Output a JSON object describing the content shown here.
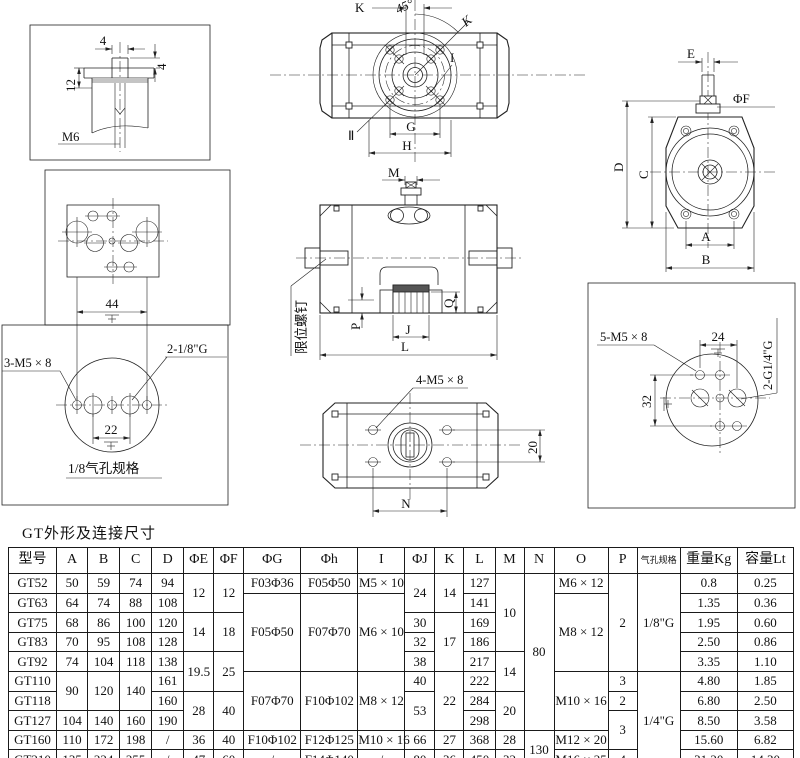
{
  "page_title": "GT外形及连接尺寸",
  "drawings": {
    "shaft_detail": {
      "dim_top": "4",
      "dim_right": "4",
      "dim_left": "12",
      "thread_label": "M6"
    },
    "top_view": {
      "dim_k": "K",
      "angle": "45°",
      "dim_k_diag": "K",
      "dim_i": "I",
      "dim_g": "G",
      "dim_h": "H",
      "mark": "Ⅱ"
    },
    "end_view": {
      "dim_e": "E",
      "dim_f": "ΦF",
      "dim_d": "D",
      "dim_c": "C",
      "dim_a": "A",
      "dim_b": "B"
    },
    "section_view": {
      "dim_m": "M",
      "dim_q": "Q",
      "dim_p": "P",
      "dim_j": "J",
      "dim_l": "L",
      "limit_screw_label": "限位螺钉"
    },
    "namur_plate": {
      "dim_width": "44"
    },
    "air_port_eighth": {
      "bolt_label": "3-M5 × 8",
      "port_label": "2-1/8\"G",
      "dim_width": "22",
      "caption": "1/8气孔规格"
    },
    "bottom_view": {
      "bolt_label": "4-M5 × 8",
      "dim_n": "N",
      "dim_height": "20"
    },
    "air_port_quarter": {
      "bolt_label": "5-M5 × 8",
      "dim_width": "24",
      "dim_height": "32",
      "port_label": "2-G1/4\"G"
    }
  },
  "table": {
    "headers": [
      "型号",
      "A",
      "B",
      "C",
      "D",
      "ΦE",
      "ΦF",
      "ΦG",
      "Φh",
      "I",
      "ΦJ",
      "K",
      "L",
      "M",
      "N",
      "O",
      "P",
      "气孔规格",
      "重量Kg",
      "容量Lt"
    ],
    "rows": [
      [
        {
          "t": "GT52"
        },
        {
          "t": "50"
        },
        {
          "t": "59"
        },
        {
          "t": "74"
        },
        {
          "t": "94"
        },
        {
          "t": "12",
          "rs": 2
        },
        {
          "t": "12",
          "rs": 2
        },
        {
          "t": "F03Φ36"
        },
        {
          "t": "F05Φ50"
        },
        {
          "t": "M5 × 10"
        },
        {
          "t": "24",
          "rs": 2
        },
        {
          "t": "14",
          "rs": 2
        },
        {
          "t": "127"
        },
        {
          "t": "10",
          "rs": 4
        },
        {
          "t": "80",
          "rs": 8
        },
        {
          "t": "M6 × 12"
        },
        {
          "t": "2",
          "rs": 5
        },
        {
          "t": "1/8\"G",
          "rs": 5
        },
        {
          "t": "0.8"
        },
        {
          "t": "0.25"
        }
      ],
      [
        {
          "t": "GT63"
        },
        {
          "t": "64"
        },
        {
          "t": "74"
        },
        {
          "t": "88"
        },
        {
          "t": "108"
        },
        {
          "t": "F05Φ50",
          "rs": 4
        },
        {
          "t": "F07Φ70",
          "rs": 4
        },
        {
          "t": "M6 × 10",
          "rs": 4
        },
        {
          "t": "141"
        },
        {
          "t": "M8 × 12",
          "rs": 4
        },
        {
          "t": "1.35"
        },
        {
          "t": "0.36"
        }
      ],
      [
        {
          "t": "GT75"
        },
        {
          "t": "68"
        },
        {
          "t": "86"
        },
        {
          "t": "100"
        },
        {
          "t": "120"
        },
        {
          "t": "14",
          "rs": 2
        },
        {
          "t": "18",
          "rs": 2
        },
        {
          "t": "30"
        },
        {
          "t": "17",
          "rs": 3
        },
        {
          "t": "169"
        },
        {
          "t": "1.95"
        },
        {
          "t": "0.60"
        }
      ],
      [
        {
          "t": "GT83"
        },
        {
          "t": "70"
        },
        {
          "t": "95"
        },
        {
          "t": "108"
        },
        {
          "t": "128"
        },
        {
          "t": "32"
        },
        {
          "t": "186"
        },
        {
          "t": "2.50"
        },
        {
          "t": "0.86"
        }
      ],
      [
        {
          "t": "GT92"
        },
        {
          "t": "74"
        },
        {
          "t": "104"
        },
        {
          "t": "118"
        },
        {
          "t": "138"
        },
        {
          "t": "19.5",
          "rs": 2
        },
        {
          "t": "25",
          "rs": 2
        },
        {
          "t": "38"
        },
        {
          "t": "217"
        },
        {
          "t": "14",
          "rs": 2
        },
        {
          "t": "3.35"
        },
        {
          "t": "1.10"
        }
      ],
      [
        {
          "t": "GT110"
        },
        {
          "t": "90",
          "rs": 2
        },
        {
          "t": "120",
          "rs": 2
        },
        {
          "t": "140",
          "rs": 2
        },
        {
          "t": "161"
        },
        {
          "t": "F07Φ70",
          "rs": 3
        },
        {
          "t": "F10Φ102",
          "rs": 3
        },
        {
          "t": "M8 × 12",
          "rs": 3
        },
        {
          "t": "40"
        },
        {
          "t": "22",
          "rs": 3
        },
        {
          "t": "222"
        },
        {
          "t": "M10 × 16",
          "rs": 3
        },
        {
          "t": "3"
        },
        {
          "t": "1/4\"G",
          "rs": 5
        },
        {
          "t": "4.80"
        },
        {
          "t": "1.85"
        }
      ],
      [
        {
          "t": "GT118"
        },
        {
          "t": "160"
        },
        {
          "t": "28",
          "rs": 2
        },
        {
          "t": "40",
          "rs": 2
        },
        {
          "t": "53",
          "rs": 2
        },
        {
          "t": "284"
        },
        {
          "t": "20",
          "rs": 2
        },
        {
          "t": "2"
        },
        {
          "t": "6.80"
        },
        {
          "t": "2.50"
        }
      ],
      [
        {
          "t": "GT127"
        },
        {
          "t": "104"
        },
        {
          "t": "140"
        },
        {
          "t": "160"
        },
        {
          "t": "190"
        },
        {
          "t": "298"
        },
        {
          "t": "3",
          "rs": 2
        },
        {
          "t": "8.50"
        },
        {
          "t": "3.58"
        }
      ],
      [
        {
          "t": "GT160"
        },
        {
          "t": "110"
        },
        {
          "t": "172"
        },
        {
          "t": "198"
        },
        {
          "t": "/"
        },
        {
          "t": "36"
        },
        {
          "t": "40"
        },
        {
          "t": "F10Φ102"
        },
        {
          "t": "F12Φ125"
        },
        {
          "t": "M10 × 16"
        },
        {
          "t": "66"
        },
        {
          "t": "27"
        },
        {
          "t": "368"
        },
        {
          "t": "28"
        },
        {
          "t": "130",
          "rs": 2
        },
        {
          "t": "M12 × 20"
        },
        {
          "t": "15.60"
        },
        {
          "t": "6.82"
        }
      ],
      [
        {
          "t": "GT210"
        },
        {
          "t": "135"
        },
        {
          "t": "224"
        },
        {
          "t": "255"
        },
        {
          "t": "/"
        },
        {
          "t": "47"
        },
        {
          "t": "60"
        },
        {
          "t": "/"
        },
        {
          "t": "F14Φ140"
        },
        {
          "t": "/"
        },
        {
          "t": "80"
        },
        {
          "t": "36"
        },
        {
          "t": "450"
        },
        {
          "t": "32"
        },
        {
          "t": "M16 × 25"
        },
        {
          "t": "4"
        },
        {
          "t": "31.20"
        },
        {
          "t": "14.30"
        }
      ]
    ]
  }
}
